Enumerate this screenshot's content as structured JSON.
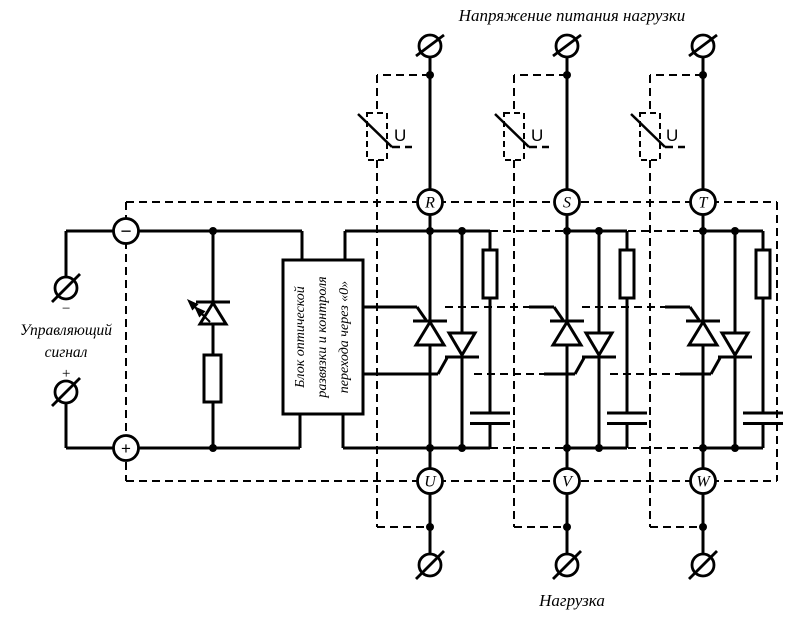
{
  "colors": {
    "ink": "#000000",
    "background": "#ffffff"
  },
  "titles": {
    "top": "Напряжение питания нагрузки",
    "bottom": "Нагрузка"
  },
  "control": {
    "label_line1": "Управляющий",
    "label_line2": "сигнал",
    "minus": "−",
    "plus": "+"
  },
  "source_polarity": {
    "minus": "−",
    "plus": "+"
  },
  "block": {
    "line1": "Блок оптической",
    "line2": "развязки и контроля",
    "line3": "перехода через «0»"
  },
  "phases": [
    {
      "input": "R",
      "output": "U"
    },
    {
      "input": "S",
      "output": "V"
    },
    {
      "input": "T",
      "output": "W"
    }
  ],
  "varistor": {
    "label": "U"
  }
}
